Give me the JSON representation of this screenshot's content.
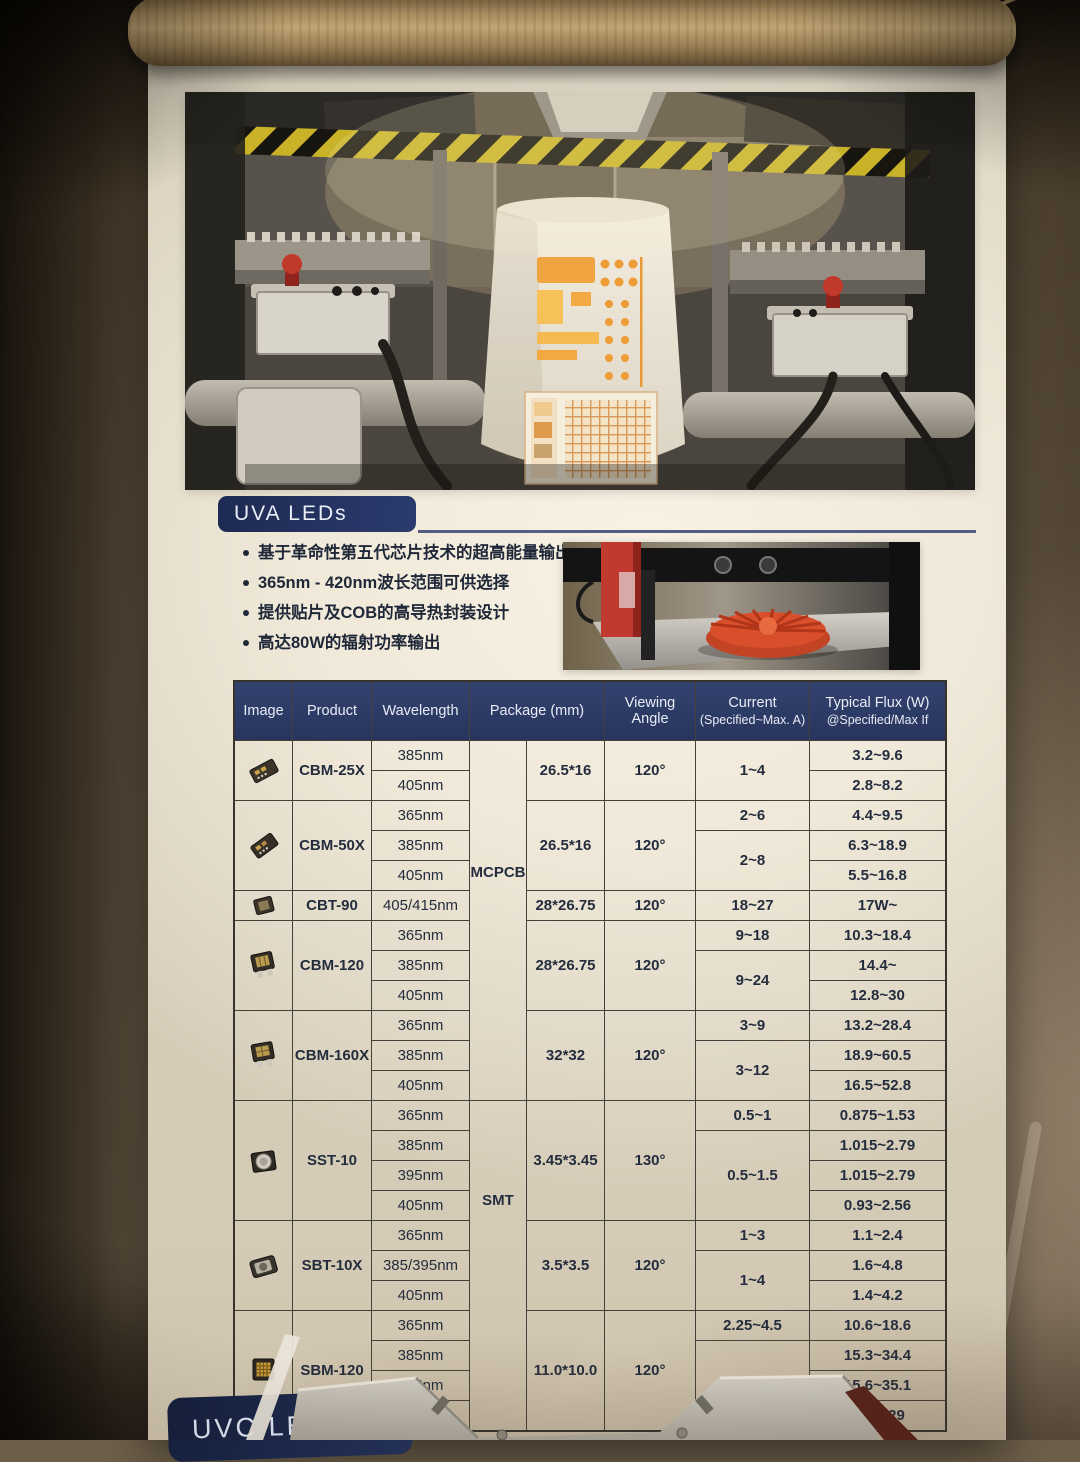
{
  "poster": {
    "uva_header": "UVA LEDs",
    "uvc_header": "UVC LE",
    "bullets": [
      "基于革命性第五代芯片技术的超高能量输出",
      "365nm - 420nm波长范围可供选择",
      "提供贴片及COB的高导热封装设计",
      "高达80W的辐射功率输出"
    ],
    "colors": {
      "header_navy": "#22305c",
      "table_header_navy": "#2c3a63",
      "hazard_yellow": "#c9b227",
      "glow_orange": "#f0a440",
      "poster_cream": "#f0e9d9"
    },
    "photos": [
      "uv-curing-machine-with-white-drum",
      "3d-printer-printing-red-impeller"
    ]
  },
  "table": {
    "headers": {
      "image": "Image",
      "product": "Product",
      "wavelength": "Wavelength",
      "package": "Package (mm)",
      "viewing": "Viewing Angle",
      "current_1": "Current",
      "current_2": "(Specified~Max. A)",
      "flux_1": "Typical Flux (W)",
      "flux_2": "@Specified/Max If"
    },
    "package_types": {
      "mcpcb": "MCPCB",
      "smt": "SMT"
    },
    "product_images": [
      "pcb-strip-module",
      "pcb-strip-module",
      "compact-module",
      "star-board-module",
      "star-board-module",
      "dome-smd-led",
      "flat-smd-led",
      "led-array-chip"
    ],
    "groups": [
      {
        "product": "CBM-25X",
        "wavelengths": [
          "385nm",
          "405nm"
        ],
        "package": "26.5*16",
        "angle": "120°",
        "currents": [
          {
            "label": "1~4",
            "rows": 2
          }
        ],
        "flux": [
          "3.2~9.6",
          "2.8~8.2"
        ]
      },
      {
        "product": "CBM-50X",
        "wavelengths": [
          "365nm",
          "385nm",
          "405nm"
        ],
        "package": "26.5*16",
        "angle": "120°",
        "currents": [
          {
            "label": "2~6",
            "rows": 1
          },
          {
            "label": "2~8",
            "rows": 2
          }
        ],
        "flux": [
          "4.4~9.5",
          "6.3~18.9",
          "5.5~16.8"
        ]
      },
      {
        "product": "CBT-90",
        "wavelengths": [
          "405/415nm"
        ],
        "package": "28*26.75",
        "angle": "120°",
        "currents": [
          {
            "label": "18~27",
            "rows": 1
          }
        ],
        "flux": [
          "17W~"
        ]
      },
      {
        "product": "CBM-120",
        "wavelengths": [
          "365nm",
          "385nm",
          "405nm"
        ],
        "package": "28*26.75",
        "angle": "120°",
        "currents": [
          {
            "label": "9~18",
            "rows": 1
          },
          {
            "label": "9~24",
            "rows": 2
          }
        ],
        "flux": [
          "10.3~18.4",
          "14.4~",
          "12.8~30"
        ]
      },
      {
        "product": "CBM-160X",
        "wavelengths": [
          "365nm",
          "385nm",
          "405nm"
        ],
        "package": "32*32",
        "angle": "120°",
        "currents": [
          {
            "label": "3~9",
            "rows": 1
          },
          {
            "label": "3~12",
            "rows": 2
          }
        ],
        "flux": [
          "13.2~28.4",
          "18.9~60.5",
          "16.5~52.8"
        ]
      },
      {
        "product": "SST-10",
        "wavelengths": [
          "365nm",
          "385nm",
          "395nm",
          "405nm"
        ],
        "package": "3.45*3.45",
        "angle": "130°",
        "currents": [
          {
            "label": "0.5~1",
            "rows": 1
          },
          {
            "label": "0.5~1.5",
            "rows": 3
          }
        ],
        "flux": [
          "0.875~1.53",
          "1.015~2.79",
          "1.015~2.79",
          "0.93~2.56"
        ]
      },
      {
        "product": "SBT-10X",
        "wavelengths": [
          "365nm",
          "385/395nm",
          "405nm"
        ],
        "package": "3.5*3.5",
        "angle": "120°",
        "currents": [
          {
            "label": "1~3",
            "rows": 1
          },
          {
            "label": "1~4",
            "rows": 2
          }
        ],
        "flux": [
          "1.1~2.4",
          "1.6~4.8",
          "1.4~4.2"
        ]
      },
      {
        "product": "SBM-120",
        "wavelengths": [
          "365nm",
          "385nm",
          "395nm",
          ""
        ],
        "package": "11.0*10.0",
        "angle": "120°",
        "currents": [
          {
            "label": "2.25~4.5",
            "rows": 1
          },
          {
            "label": "2.25~6",
            "rows": 3
          }
        ],
        "flux": [
          "10.6~18.6",
          "15.3~34.4",
          "15.6~35.1",
          "12.8~29"
        ]
      }
    ]
  }
}
